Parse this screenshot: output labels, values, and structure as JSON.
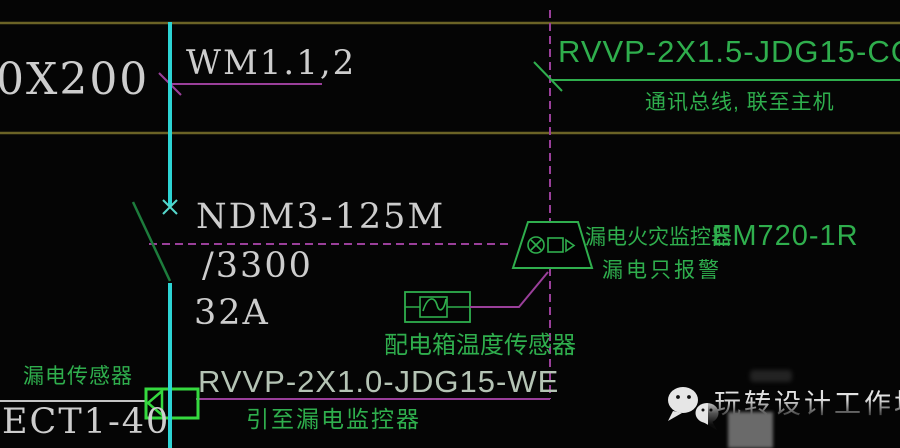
{
  "diagram": {
    "bus": {
      "size_label": "0X200",
      "feeder_label": "WM1.1,2"
    },
    "breaker": {
      "model": "NDM3-125M",
      "trip_unit": "/3300",
      "rating": "32A"
    },
    "comm_cable": {
      "code": "RVVP-2X1.5-JDG15-CC",
      "note": "通讯总线, 联至主机"
    },
    "monitor": {
      "name": "漏电火灾监控器",
      "model": "EM720-1R",
      "note": "漏电只报警"
    },
    "temp_sensor": {
      "name": "配电箱温度传感器"
    },
    "leakage_sensor": {
      "name": "漏电传感器",
      "model": "ECT1-40"
    },
    "leakage_cable": {
      "code": "RVVP-2X1.0-JDG15-WE",
      "note": "引至漏电监控器"
    },
    "watermark": {
      "text": "玩转设计工作坊"
    }
  },
  "icons": {
    "wechat": "wechat-icon",
    "breaker_blade": "circuit-breaker-symbol",
    "monitor_trapezoid": "leakage-fire-monitor-symbol",
    "circle_x": "circle-x-icon",
    "camera": "camera-icon",
    "temp_sensor_box": "temperature-sensor-symbol",
    "current_transformer": "current-transformer-symbol"
  },
  "colors": {
    "background": "#050505",
    "cad_green": "#2fae4d",
    "cad_magenta": "#9a3f9a",
    "cad_cyan": "#2dd4d4",
    "busbar_olive": "#6b6326",
    "white_text": "#cdcdcd",
    "pale_code_text": "#b5c4b5"
  }
}
